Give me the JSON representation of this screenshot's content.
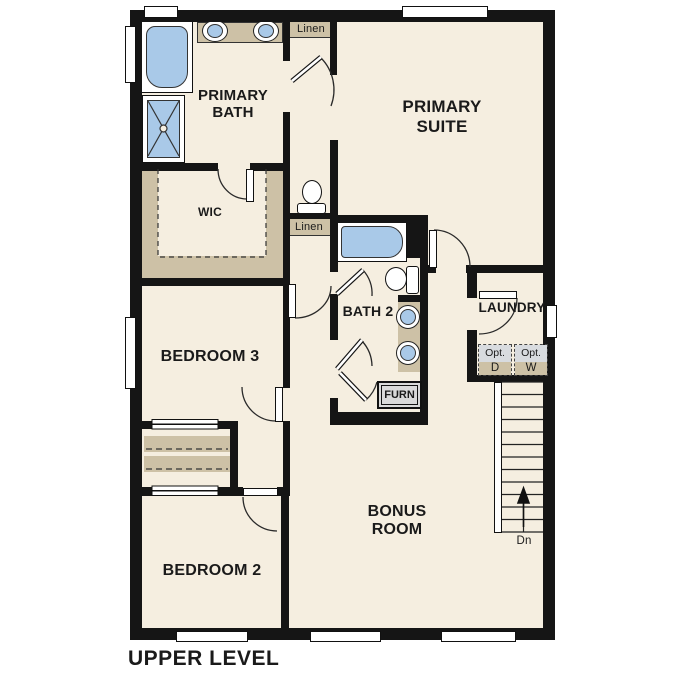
{
  "title": "UPPER LEVEL",
  "rooms": {
    "primary_bath": "PRIMARY BATH",
    "primary_suite": "PRIMARY SUITE",
    "wic": "WIC",
    "bedroom3": "BEDROOM 3",
    "bath2": "BATH 2",
    "laundry": "LAUNDRY",
    "bonus_room": "BONUS ROOM",
    "bedroom2": "BEDROOM 2"
  },
  "closets": {
    "linen_top": "Linen",
    "linen_mid": "Linen",
    "furnace": "FURN"
  },
  "laundry_appliances": {
    "dryer": {
      "opt": "Opt.",
      "label": "D"
    },
    "washer": {
      "opt": "Opt.",
      "label": "W"
    }
  },
  "stairs": {
    "direction": "Dn",
    "arrow": "up"
  },
  "fixtures": {
    "primary_bath": [
      "bathtub",
      "shower",
      "double-sink-vanity",
      "toilet"
    ],
    "bath2": [
      "bathtub",
      "toilet",
      "double-sink-vanity"
    ]
  },
  "colors": {
    "wall": "#151515",
    "floor": "#f5eee0",
    "shelf": "#cdc1a6",
    "fixture_blue": "#a9c9e8",
    "opt_gray": "#d8dbdf",
    "furn_gray": "#d9d9d9",
    "background": "#ffffff"
  }
}
